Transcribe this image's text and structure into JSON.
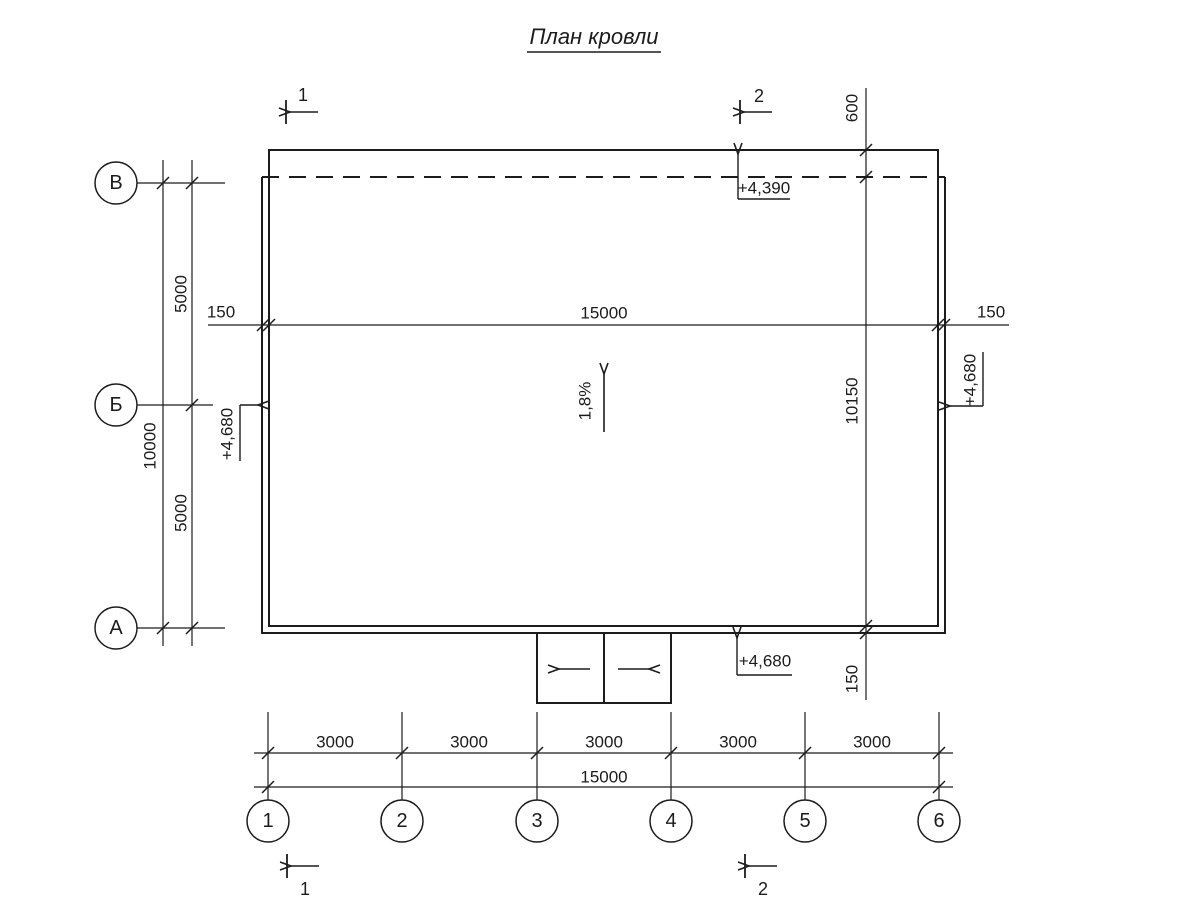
{
  "title": "План кровли",
  "colors": {
    "line": "#1c1c1c",
    "background": "#ffffff"
  },
  "axes": {
    "rows": [
      {
        "label": "В"
      },
      {
        "label": "Б"
      },
      {
        "label": "А"
      }
    ],
    "columns": [
      {
        "label": "1"
      },
      {
        "label": "2"
      },
      {
        "label": "3"
      },
      {
        "label": "4"
      },
      {
        "label": "5"
      },
      {
        "label": "6"
      }
    ]
  },
  "dimensions": {
    "left": {
      "segment_top": "5000",
      "segment_bottom": "5000",
      "total": "10000"
    },
    "top": {
      "overhang_left": "150",
      "span": "15000",
      "overhang_right": "150"
    },
    "right": {
      "top_offset": "600",
      "span": "10150",
      "bottom_offset": "150"
    },
    "bottom": {
      "bays": [
        "3000",
        "3000",
        "3000",
        "3000",
        "3000"
      ],
      "total": "15000"
    }
  },
  "elevations": {
    "top": "+4,390",
    "left": "+4,680",
    "right": "+4,680",
    "bottom": "+4,680"
  },
  "slope": {
    "label": "1,8%"
  },
  "sections": {
    "top_left": "1",
    "top_right": "2",
    "bottom_left": "1",
    "bottom_right": "2"
  }
}
